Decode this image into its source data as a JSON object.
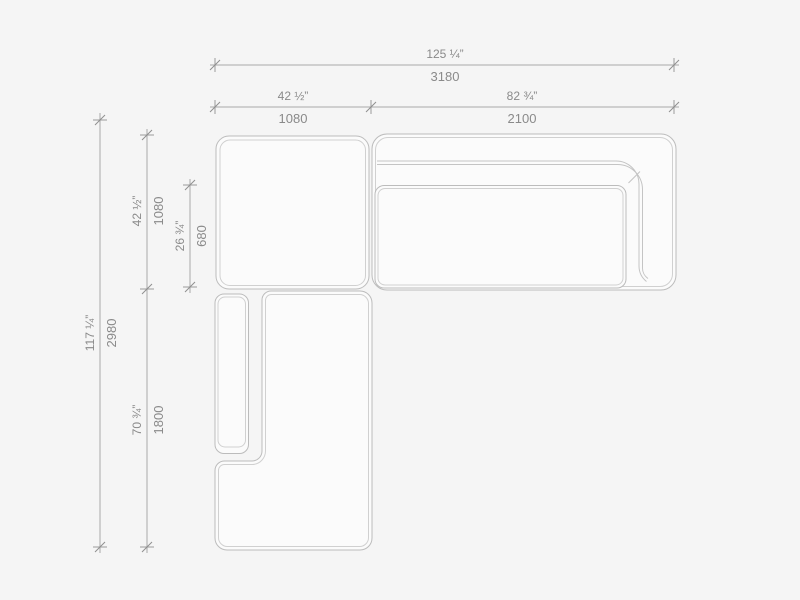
{
  "colors": {
    "background": "#f5f5f5",
    "shape_fill": "#fbfbfb",
    "shape_outline": "#bcbcbc",
    "shape_outline_inner": "#d0d0d0",
    "dimension_line": "#a9a9a9",
    "label_text": "#8a8a8a"
  },
  "dims": {
    "width_total": {
      "inches": "125 ¼”",
      "mm": "3180"
    },
    "width_left": {
      "inches": "42 ½”",
      "mm": "1080"
    },
    "width_right": {
      "inches": "82 ¾”",
      "mm": "2100"
    },
    "height_total": {
      "inches": "117 ¼”",
      "mm": "2980"
    },
    "height_upper": {
      "inches": "42 ½”",
      "mm": "1080"
    },
    "height_seat": {
      "inches": "26 ¾”",
      "mm": "680"
    },
    "height_lower": {
      "inches": "70 ¾”",
      "mm": "1800"
    }
  },
  "modules": [
    {
      "name": "square-ottoman-module"
    },
    {
      "name": "sofa-module-back-and-right-arm"
    },
    {
      "name": "chaise-module-left-arm-cushion"
    }
  ]
}
